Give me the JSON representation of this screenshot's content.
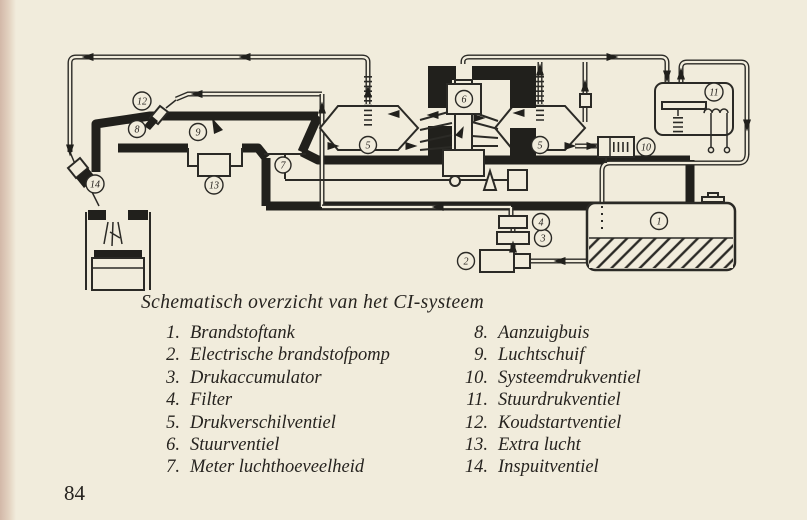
{
  "page": {
    "caption": "Schematisch overzicht van het CI-systeem",
    "page_number": "84"
  },
  "colors": {
    "paper": "#f1ecdc",
    "ink": "#2b2a26"
  },
  "legend": {
    "left": [
      {
        "n": "1.",
        "label": "Brandstoftank"
      },
      {
        "n": "2.",
        "label": "Electrische brandstofpomp"
      },
      {
        "n": "3.",
        "label": "Drukaccumulator"
      },
      {
        "n": "4.",
        "label": "Filter"
      },
      {
        "n": "5.",
        "label": "Drukverschilventiel"
      },
      {
        "n": "6.",
        "label": "Stuurventiel"
      },
      {
        "n": "7.",
        "label": "Meter luchthoeveelheid"
      }
    ],
    "right": [
      {
        "n": "8.",
        "label": "Aanzuigbuis"
      },
      {
        "n": "9.",
        "label": "Luchtschuif"
      },
      {
        "n": "10.",
        "label": "Systeemdrukventiel"
      },
      {
        "n": "11.",
        "label": "Stuurdrukventiel"
      },
      {
        "n": "12.",
        "label": "Koudstartventiel"
      },
      {
        "n": "13.",
        "label": "Extra lucht"
      },
      {
        "n": "14.",
        "label": "Inspuitventiel"
      }
    ]
  },
  "diagram": {
    "callouts": {
      "c1": "1",
      "c2": "2",
      "c3": "3",
      "c4": "4",
      "c5": "5",
      "c6": "6",
      "c7": "7",
      "c8": "8",
      "c9": "9",
      "c10": "10",
      "c11": "11",
      "c12": "12",
      "c13": "13",
      "c14": "14"
    }
  }
}
